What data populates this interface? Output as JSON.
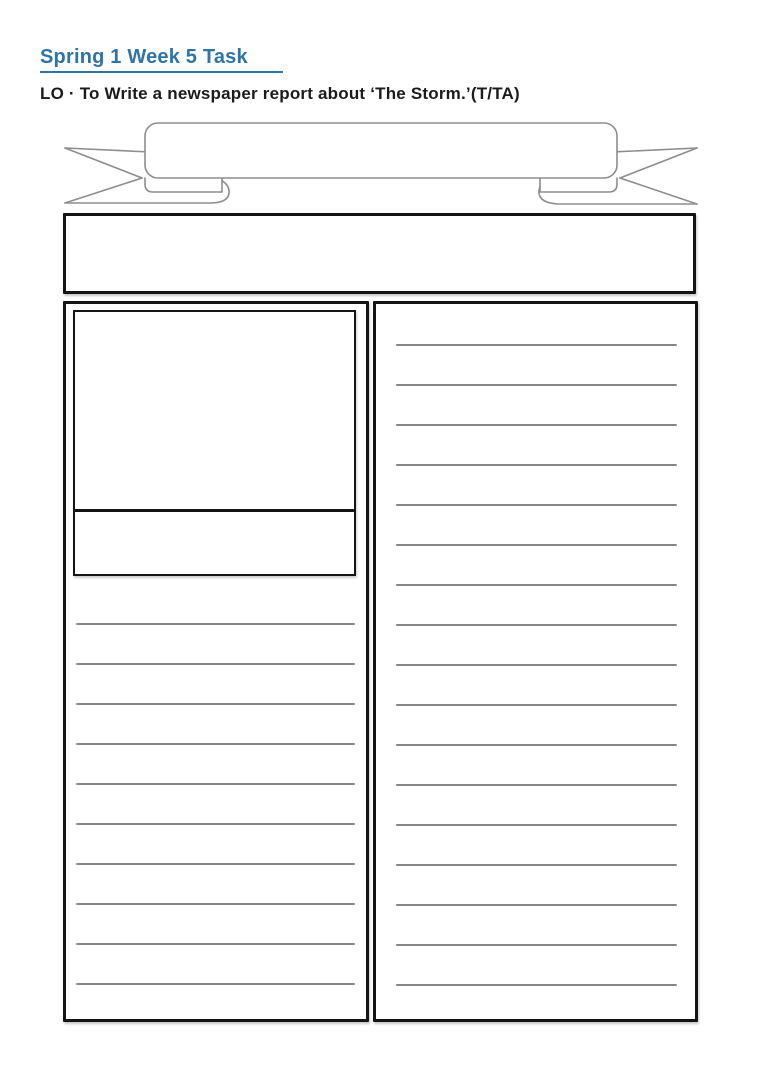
{
  "header": {
    "title": "Spring 1 Week 5 Task",
    "learning_objective": "LO ·  To Write a newspaper report about ‘The Storm.’(T/TA)"
  },
  "ruled_lines": {
    "left_column_count": 10,
    "right_column_count": 17
  },
  "colors": {
    "title_blue": "#2E74A5",
    "rule_gray": "#868686",
    "box_border_black": "#141414",
    "banner_outline_gray": "#8d8d8d"
  }
}
